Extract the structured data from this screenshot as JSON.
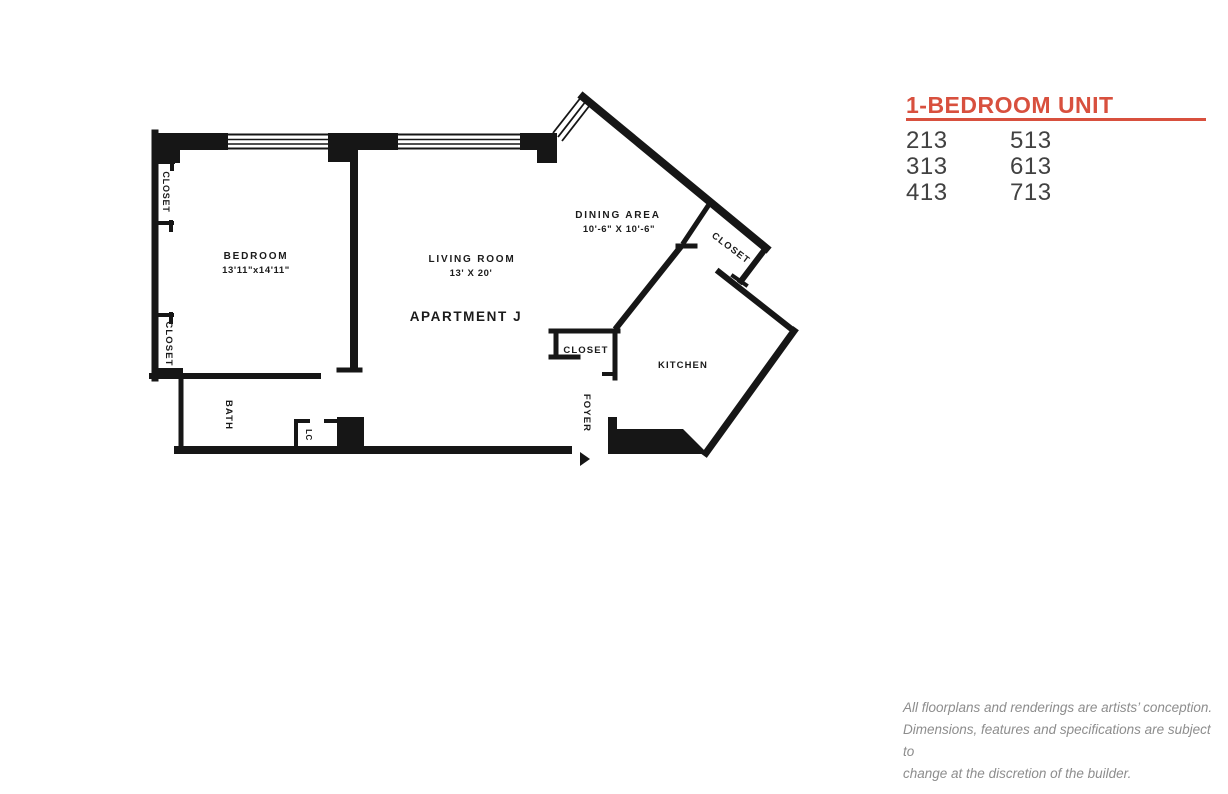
{
  "panel": {
    "title": "1-BEDROOM UNIT",
    "accent_color": "#d8503e",
    "text_color": "#414141",
    "units": [
      "213",
      "513",
      "313",
      "613",
      "413",
      "713"
    ]
  },
  "floorplan": {
    "apartment": "APARTMENT J",
    "bedroom_name": "BEDROOM",
    "bedroom_dims": "13'11\"x14'11\"",
    "living_name": "LIVING ROOM",
    "living_dims": "13' X 20'",
    "dining_name": "DINING AREA",
    "dining_dims": "10'-6\" X 10'-6\"",
    "kitchen": "KITCHEN",
    "bath": "BATH",
    "foyer": "FOYER",
    "lc": "LC",
    "closet_upper_left": "CLOSET",
    "closet_lower_left": "CLOSET",
    "closet_dining": "CLOSET",
    "closet_foyer": "CLOSET"
  },
  "disclaimer": {
    "lines": [
      "All floorplans and renderings are artists’ conception.",
      "Dimensions, features and specifications are subject to",
      "change at the discretion of the builder."
    ]
  }
}
